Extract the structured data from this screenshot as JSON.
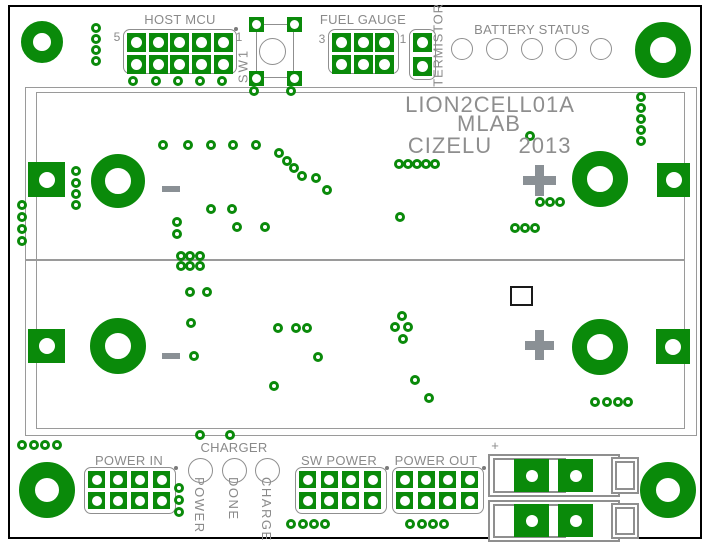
{
  "title_block": {
    "product": "LION2CELL01A",
    "org": "MLAB",
    "author": "CIZELU",
    "year": "2013"
  },
  "silkscreen_labels": {
    "host_mcu": "HOST MCU",
    "host_mcu_pin_left": "5",
    "host_mcu_pin_right": "1",
    "sw1": "SW1",
    "fuel_gauge": "FUEL GAUGE",
    "fuel_gauge_pin_left": "3",
    "fuel_gauge_pin_right": "1",
    "termistor": "TERMISTOR",
    "battery_status": "BATTERY STATUS",
    "charger": "CHARGER",
    "charger_leds": [
      "POWER",
      "DONE",
      "CHARGE"
    ],
    "power_in": "POWER IN",
    "sw_power": "SW POWER",
    "power_out": "POWER OUT",
    "battery_minus": "-",
    "battery_plus": "+",
    "connector_plus": "+"
  },
  "colors": {
    "copper_green": "#0a8a0a",
    "silk_gray": "#8a8a8a",
    "text_gray": "#8e8e8e",
    "frame_black": "#000000"
  },
  "pcb_geometry": {
    "vias": [
      [
        96,
        28
      ],
      [
        96,
        39
      ],
      [
        96,
        50
      ],
      [
        96,
        61
      ],
      [
        133,
        81
      ],
      [
        156,
        81
      ],
      [
        178,
        81
      ],
      [
        200,
        81
      ],
      [
        222,
        81
      ],
      [
        254,
        91
      ],
      [
        291,
        91
      ],
      [
        641,
        97
      ],
      [
        641,
        108
      ],
      [
        641,
        119
      ],
      [
        641,
        130
      ],
      [
        641,
        141
      ],
      [
        530,
        136
      ],
      [
        163,
        145
      ],
      [
        188,
        145
      ],
      [
        211,
        145
      ],
      [
        233,
        145
      ],
      [
        256,
        145
      ],
      [
        279,
        153
      ],
      [
        287,
        161
      ],
      [
        294,
        168
      ],
      [
        302,
        176
      ],
      [
        316,
        178
      ],
      [
        327,
        190
      ],
      [
        211,
        209
      ],
      [
        232,
        209
      ],
      [
        177,
        222
      ],
      [
        177,
        234
      ],
      [
        237,
        227
      ],
      [
        265,
        227
      ],
      [
        399,
        164
      ],
      [
        408,
        164
      ],
      [
        417,
        164
      ],
      [
        426,
        164
      ],
      [
        435,
        164
      ],
      [
        400,
        217
      ],
      [
        540,
        202
      ],
      [
        550,
        202
      ],
      [
        560,
        202
      ],
      [
        515,
        228
      ],
      [
        525,
        228
      ],
      [
        535,
        228
      ],
      [
        22,
        205
      ],
      [
        22,
        217
      ],
      [
        22,
        229
      ],
      [
        22,
        241
      ],
      [
        76,
        171
      ],
      [
        76,
        183
      ],
      [
        76,
        194
      ],
      [
        76,
        205
      ],
      [
        181,
        256
      ],
      [
        190,
        256
      ],
      [
        200,
        256
      ],
      [
        181,
        266
      ],
      [
        190,
        266
      ],
      [
        200,
        266
      ],
      [
        190,
        292
      ],
      [
        207,
        292
      ],
      [
        191,
        323
      ],
      [
        194,
        356
      ],
      [
        278,
        328
      ],
      [
        296,
        328
      ],
      [
        307,
        328
      ],
      [
        318,
        357
      ],
      [
        274,
        386
      ],
      [
        402,
        316
      ],
      [
        395,
        327
      ],
      [
        408,
        327
      ],
      [
        403,
        339
      ],
      [
        415,
        380
      ],
      [
        429,
        398
      ],
      [
        595,
        402
      ],
      [
        607,
        402
      ],
      [
        618,
        402
      ],
      [
        628,
        402
      ],
      [
        22,
        445
      ],
      [
        34,
        445
      ],
      [
        45,
        445
      ],
      [
        57,
        445
      ],
      [
        200,
        435
      ],
      [
        230,
        435
      ],
      [
        179,
        488
      ],
      [
        179,
        500
      ],
      [
        179,
        512
      ],
      [
        291,
        524
      ],
      [
        303,
        524
      ],
      [
        314,
        524
      ],
      [
        325,
        524
      ],
      [
        410,
        524
      ],
      [
        422,
        524
      ],
      [
        433,
        524
      ],
      [
        444,
        524
      ]
    ],
    "rings": [
      [
        42,
        42,
        21,
        9,
        "mount-hole-top-left"
      ],
      [
        663,
        50,
        28,
        13,
        "mount-hole-top-right"
      ],
      [
        47,
        490,
        28,
        12,
        "mount-hole-bottom-left"
      ],
      [
        668,
        490,
        28,
        12,
        "mount-hole-bottom-right"
      ],
      [
        118,
        181,
        27,
        13,
        "battery1-minus-terminal"
      ],
      [
        600,
        179,
        28,
        13,
        "battery1-plus-terminal"
      ],
      [
        118,
        346,
        28,
        13,
        "battery2-minus-terminal"
      ],
      [
        600,
        347,
        28,
        13,
        "battery2-plus-terminal"
      ]
    ],
    "square_pads": [
      [
        28,
        162,
        37,
        35,
        16,
        "battery1-neg-edge-pad"
      ],
      [
        657,
        163,
        33,
        34,
        16,
        "battery1-pos-edge-pad"
      ],
      [
        28,
        329,
        37,
        34,
        16,
        "battery2-neg-edge-pad"
      ],
      [
        656,
        329,
        34,
        35,
        16,
        "battery2-pos-edge-pad"
      ],
      [
        514,
        459,
        35,
        33,
        12,
        "connector-pad-1"
      ],
      [
        558,
        459,
        35,
        33,
        12,
        "connector-pad-2"
      ],
      [
        514,
        504,
        35,
        33,
        12,
        "connector-pad-3"
      ],
      [
        558,
        504,
        35,
        33,
        12,
        "connector-pad-4"
      ]
    ],
    "headers": [
      {
        "name": "host-mcu-header",
        "x": 127,
        "y": 33,
        "cols": 5,
        "rows": 2,
        "pad": 19,
        "pitchX": 21.7,
        "pitchY": 21.7,
        "hole": 11,
        "outline": [
          123,
          29,
          114,
          45
        ],
        "dot": [
          234,
          27
        ]
      },
      {
        "name": "fuel-gauge-header",
        "x": 332,
        "y": 33,
        "cols": 3,
        "rows": 2,
        "pad": 19,
        "pitchX": 21.7,
        "pitchY": 21.7,
        "hole": 11,
        "outline": [
          328,
          29,
          71,
          45
        ],
        "dot": null
      },
      {
        "name": "termistor-header",
        "x": 413,
        "y": 33,
        "cols": 1,
        "rows": 2,
        "pad": 19,
        "pitchX": 21.7,
        "pitchY": 23.5,
        "hole": 11,
        "outline": [
          409,
          29,
          27,
          51
        ],
        "dot": null
      },
      {
        "name": "power-in-header",
        "x": 88,
        "y": 471,
        "cols": 4,
        "rows": 2,
        "pad": 17,
        "pitchX": 21.7,
        "pitchY": 21,
        "hole": 10,
        "outline": [
          84,
          467,
          92,
          47
        ],
        "dot": [
          174,
          466
        ]
      },
      {
        "name": "sw-power-header",
        "x": 299,
        "y": 471,
        "cols": 4,
        "rows": 2,
        "pad": 17,
        "pitchX": 21.7,
        "pitchY": 21,
        "hole": 10,
        "outline": [
          295,
          467,
          92,
          47
        ],
        "dot": [
          385,
          466
        ]
      },
      {
        "name": "power-out-header",
        "x": 396,
        "y": 471,
        "cols": 4,
        "rows": 2,
        "pad": 17,
        "pitchX": 21.7,
        "pitchY": 21,
        "hole": 10,
        "outline": [
          392,
          467,
          92,
          47
        ],
        "dot": [
          482,
          466
        ]
      }
    ],
    "sw1": {
      "pads": [
        [
          248.5,
          16.5
        ],
        [
          286.5,
          16.5
        ],
        [
          248.5,
          70.5
        ],
        [
          286.5,
          70.5
        ]
      ],
      "pad": 15,
      "hole": 9,
      "rect": [
        256,
        24,
        38,
        54
      ],
      "circle": [
        272,
        51,
        13.5
      ]
    },
    "led_groups": [
      {
        "name": "battery-status-led",
        "cy": 49,
        "r": 11,
        "cx": [
          462,
          497,
          532,
          566,
          601
        ]
      },
      {
        "name": "charger-led",
        "cy": 470,
        "r": 12.5,
        "cx": [
          200,
          234,
          267
        ]
      }
    ],
    "marks": [
      {
        "name": "battery1-minus-mark",
        "type": "minus",
        "x": 162,
        "y": 186,
        "w": 18,
        "h": 6
      },
      {
        "name": "battery1-plus-mark",
        "type": "plus",
        "cx": 539,
        "cy": 180,
        "w": 33,
        "h": 31,
        "bar": 9
      },
      {
        "name": "battery2-minus-mark",
        "type": "minus",
        "x": 162,
        "y": 353,
        "w": 18,
        "h": 6
      },
      {
        "name": "battery2-plus-mark",
        "type": "plus",
        "cx": 539,
        "cy": 345,
        "w": 29,
        "h": 30,
        "bar": 9
      }
    ]
  }
}
